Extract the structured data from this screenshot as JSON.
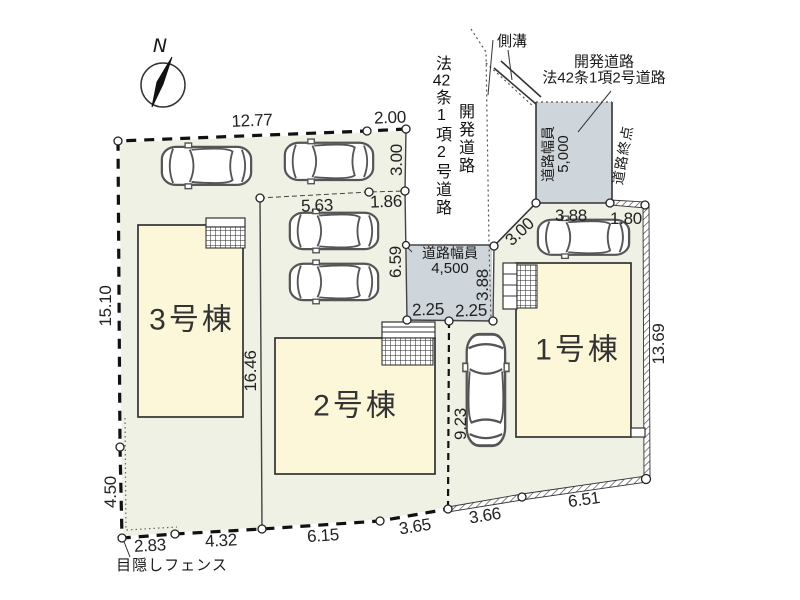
{
  "title": "分譲区画図",
  "colors": {
    "ground": "#eef1e4",
    "building": "#fcf7d8",
    "road": "#cfd6db",
    "line": "#333333"
  },
  "compass": {
    "north": "N"
  },
  "buildings": {
    "b1": "1号棟",
    "b2": "2号棟",
    "b3": "3号棟"
  },
  "roads": {
    "gutter": "側溝",
    "dev_road_line1": "開発道路",
    "dev_road_line2": "法42条1項2号道路",
    "side_col_first": "開発道路",
    "side_col_second_a": "法",
    "side_col_second_b": "42",
    "side_col_second_c": "条1項2号道路",
    "width_5000_l1": "道路幅員",
    "width_5000_l2": "5,000",
    "road_end": "道路終点",
    "width_4500_l1": "道路幅員",
    "width_4500_l2": "4,500"
  },
  "fence_label": "目隠しフェンス",
  "dims": {
    "top_1277": "12.77",
    "top_200": "2.00",
    "right_300": "3.00",
    "park_563": "5.63",
    "park_186": "1.86",
    "v_659": "6.59",
    "left_1510": "15.10",
    "v_1646": "16.46",
    "left_450": "4.50",
    "b_283": "2.83",
    "b_432": "4.32",
    "b_615": "6.15",
    "b_365": "3.65",
    "b_366": "3.66",
    "b_651": "6.51",
    "v_923": "9.23",
    "w_225a": "2.25",
    "w_225b": "2.25",
    "v_388": "3.88",
    "t_388": "3.88",
    "t_180": "1.80",
    "diag_300": "3.00",
    "r_1369": "13.69"
  }
}
